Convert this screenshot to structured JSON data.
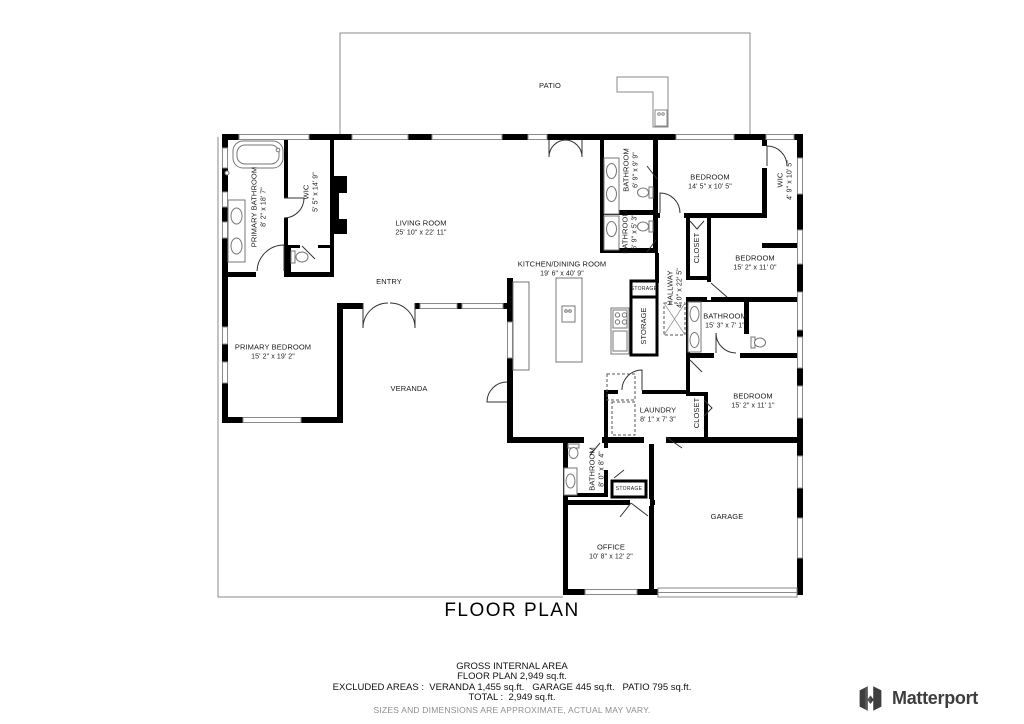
{
  "page": {
    "title": "FLOOR PLAN"
  },
  "rooms": {
    "patio": {
      "label": "PATIO"
    },
    "primary_bathroom": {
      "label": "PRIMARY BATHROOM",
      "dims": "8' 2\" x 18' 7\""
    },
    "wic_primary": {
      "label": "WIC",
      "dims": "5' 5\" x 14' 9\""
    },
    "living_room": {
      "label": "LIVING ROOM",
      "dims": "25' 10\" x 22' 11\""
    },
    "entry": {
      "label": "ENTRY"
    },
    "kitchen_dining": {
      "label": "KITCHEN/DINING ROOM",
      "dims": "19' 6\" x 40' 9\""
    },
    "primary_bedroom": {
      "label": "PRIMARY BEDROOM",
      "dims": "15' 2\" x 19' 2\""
    },
    "veranda": {
      "label": "VERANDA"
    },
    "bathroom_top1": {
      "label": "BATHROOM",
      "dims": "6' 9\" x 9' 9\""
    },
    "bathroom_top2": {
      "label": "BATHROOM",
      "dims": "6' 9\" x 5' 3\""
    },
    "bedroom_ne": {
      "label": "BEDROOM",
      "dims": "14' 5\" x 10' 5\""
    },
    "wic_ne": {
      "label": "WIC",
      "dims": "4' 9\" x 10' 5\""
    },
    "closet_ne": {
      "label": "CLOSET"
    },
    "bedroom_e": {
      "label": "BEDROOM",
      "dims": "15' 2\" x 11' 0\""
    },
    "hallway": {
      "label": "HALLWAY",
      "dims": "4' 0\" x 22' 5\""
    },
    "storage_hall_small": {
      "label": "STORAGE"
    },
    "storage_hall": {
      "label": "STORAGE"
    },
    "bathroom_e": {
      "label": "BATHROOM",
      "dims": "15' 3\" x 7' 1\""
    },
    "bedroom_se": {
      "label": "BEDROOM",
      "dims": "15' 2\" x 11' 1\""
    },
    "closet_se": {
      "label": "CLOSET"
    },
    "laundry": {
      "label": "LAUNDRY",
      "dims": "8' 1\" x 7' 3\""
    },
    "bathroom_s": {
      "label": "BATHROOM",
      "dims": "8' 0\" x 8' 4\""
    },
    "storage_s": {
      "label": "STORAGE"
    },
    "office": {
      "label": "OFFICE",
      "dims": "10' 8\" x 12' 2\""
    },
    "garage": {
      "label": "GARAGE"
    }
  },
  "footer": {
    "gross_internal_area": "GROSS INTERNAL AREA",
    "floor_plan_total": "FLOOR PLAN 2,949 sq.ft.",
    "excluded_areas": "EXCLUDED AREAS :  VERANDA 1,455 sq.ft.   GARAGE 445 sq.ft.   PATIO 795 sq.ft.",
    "total": "TOTAL :  2,949 sq.ft.",
    "disclaimer": "SIZES AND DIMENSIONS ARE APPROXIMATE, ACTUAL MAY VARY."
  },
  "branding": {
    "logo_text": "Matterport"
  },
  "colors": {
    "wall": "#000000",
    "thin_line": "#8a8a8a",
    "text": "#1a1a1a",
    "disclaimer_text": "#8e8e8e",
    "logo": "#3e3e3e"
  }
}
